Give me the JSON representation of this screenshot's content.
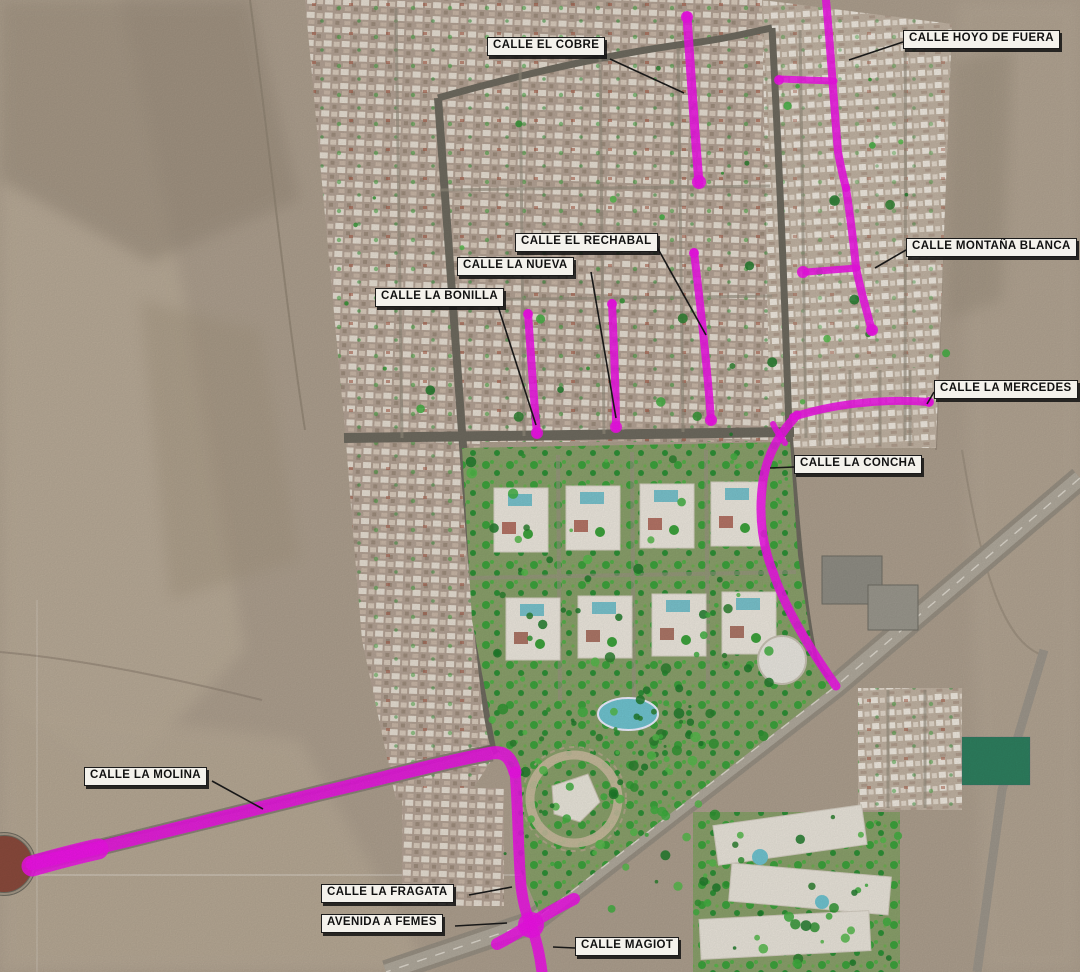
{
  "map": {
    "colors": {
      "highlight": "#ee12e6",
      "leader": "#1a1a1a",
      "label_bg": "#f4f2ec",
      "label_border": "#1b1b1b",
      "label_text": "#111111",
      "desert": "#ad9f8e",
      "road": "#6e6a5f",
      "highway": "#978f82",
      "roundabout_fill": "#8a4a3c",
      "tree_palette": [
        "#2f9431",
        "#3fae3f",
        "#2a7f2e",
        "#54b84a",
        "#1f7a2a"
      ]
    },
    "roundabout": {
      "cx": 4,
      "cy": 864,
      "r": 30
    },
    "streets": [
      {
        "id": "calle-el-cobre",
        "name": "CALLE EL COBRE",
        "label": {
          "x": 487,
          "y": 37
        },
        "leader": [
          610,
          59,
          684,
          93
        ],
        "paths": [
          {
            "d": "M687,16 C690,62 694,122 699,183",
            "w": 9
          }
        ],
        "dots": [
          [
            687,
            17,
            6
          ],
          [
            699,
            182,
            7
          ]
        ]
      },
      {
        "id": "calle-hoyo-de-fuera",
        "name": "CALLE HOYO DE FUERA",
        "label": {
          "x": 903,
          "y": 30
        },
        "leader": [
          903,
          42,
          849,
          60
        ],
        "paths": [
          {
            "d": "M826,0 C830,42 833,92 838,152 C841,168 843,177 846,188",
            "w": 8
          },
          {
            "d": "M779,79 L834,81",
            "w": 7
          }
        ],
        "dots": [
          [
            779,
            80,
            5
          ]
        ]
      },
      {
        "id": "calle-montana-blanca",
        "name": "CALLE MONTAÑA BLANCA",
        "label": {
          "x": 906,
          "y": 238
        },
        "leader": [
          906,
          250,
          875,
          268
        ],
        "paths": [
          {
            "d": "M846,188 C851,222 854,246 856,268 C861,292 867,312 872,331",
            "w": 8
          },
          {
            "d": "M806,272 L857,268",
            "w": 7
          }
        ],
        "dots": [
          [
            803,
            272,
            6
          ],
          [
            872,
            330,
            6
          ]
        ]
      },
      {
        "id": "calle-el-rechabal",
        "name": "CALLE EL RECHABAL",
        "label": {
          "x": 515,
          "y": 233
        },
        "leader": [
          657,
          247,
          706,
          335
        ],
        "paths": [
          {
            "d": "M694,252 C700,302 707,362 711,421",
            "w": 8
          }
        ],
        "dots": [
          [
            694,
            253,
            5
          ],
          [
            711,
            420,
            6
          ]
        ]
      },
      {
        "id": "calle-la-nueva",
        "name": "CALLE LA NUEVA",
        "label": {
          "x": 457,
          "y": 257
        },
        "leader": [
          591,
          272,
          616,
          418
        ],
        "paths": [
          {
            "d": "M612,303 C614,347 616,392 616,428",
            "w": 8
          }
        ],
        "dots": [
          [
            612,
            304,
            5
          ],
          [
            616,
            427,
            6
          ]
        ]
      },
      {
        "id": "calle-la-bonilla",
        "name": "CALLE LA BONILLA",
        "label": {
          "x": 375,
          "y": 288
        },
        "leader": [
          497,
          303,
          536,
          425
        ],
        "paths": [
          {
            "d": "M528,313 C531,357 534,402 537,434",
            "w": 8
          }
        ],
        "dots": [
          [
            528,
            314,
            5
          ],
          [
            537,
            433,
            6
          ]
        ]
      },
      {
        "id": "calle-la-mercedes",
        "name": "CALLE LA MERCEDES",
        "label": {
          "x": 934,
          "y": 380
        },
        "leader": [
          934,
          392,
          927,
          404
        ],
        "paths": [
          {
            "d": "M793,417 C830,405 880,398 929,402",
            "w": 8
          }
        ],
        "dots": [
          [
            929,
            402,
            5
          ]
        ]
      },
      {
        "id": "calle-la-concha",
        "name": "CALLE LA CONCHA",
        "label": {
          "x": 794,
          "y": 455
        },
        "leader": [
          794,
          467,
          770,
          468
        ],
        "paths": [
          {
            "d": "M797,415 C785,428 768,448 763,481 C758,516 763,547 773,572 C783,602 802,638 836,686",
            "w": 9
          },
          {
            "d": "M773,424 C777,432 781,438 785,443",
            "w": 6
          }
        ],
        "dots": []
      },
      {
        "id": "calle-la-molina",
        "name": "CALLE LA MOLINA",
        "label": {
          "x": 84,
          "y": 767
        },
        "leader": [
          212,
          781,
          263,
          809
        ],
        "paths": [
          {
            "d": "M32,864 C100,847 220,818 320,793 C392,776 452,760 492,753 C505,751 511,758 515,772",
            "w": 13
          },
          {
            "d": "M32,866 C60,858 80,853 98,849",
            "w": 21
          }
        ],
        "dots": []
      },
      {
        "id": "calle-la-fragata",
        "name": "CALLE LA FRAGATA",
        "label": {
          "x": 321,
          "y": 884
        },
        "leader": [
          469,
          895,
          512,
          887
        ],
        "paths": [
          {
            "d": "M515,772 C518,802 518,852 521,886 C523,903 526,914 531,925",
            "w": 11
          }
        ],
        "dots": []
      },
      {
        "id": "avenida-a-femes",
        "name": "AVENIDA A FEMES",
        "label": {
          "x": 321,
          "y": 914
        },
        "leader": [
          455,
          926,
          507,
          923
        ],
        "paths": [
          {
            "d": "M574,899 C556,908 544,915 531,924 C519,932 509,938 497,944",
            "w": 12
          }
        ],
        "dots": [
          [
            531,
            925,
            13
          ]
        ]
      },
      {
        "id": "calle-magiot",
        "name": "CALLE MAGIOT",
        "label": {
          "x": 575,
          "y": 937
        },
        "leader": [
          575,
          948,
          553,
          947
        ],
        "paths": [
          {
            "d": "M531,925 C537,941 540,956 542,972",
            "w": 11
          }
        ],
        "dots": []
      }
    ]
  }
}
